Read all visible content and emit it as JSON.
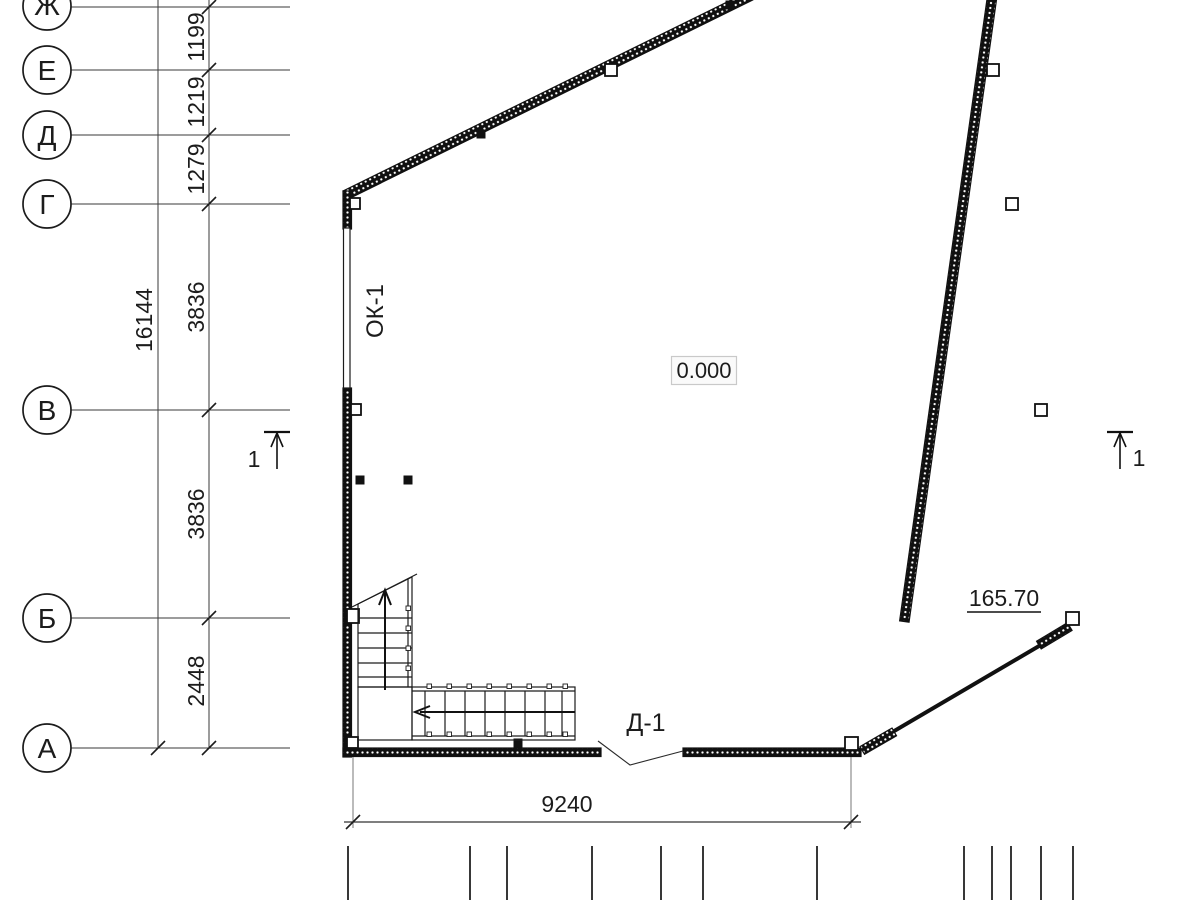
{
  "axes": [
    {
      "label": "Ж"
    },
    {
      "label": "Е"
    },
    {
      "label": "Д"
    },
    {
      "label": "Г"
    },
    {
      "label": "В"
    },
    {
      "label": "Б"
    },
    {
      "label": "А"
    }
  ],
  "dims": {
    "chain": [
      "1199",
      "1219",
      "1279",
      "3836",
      "3836",
      "2448"
    ],
    "total_left": "16144",
    "bottom": "9240"
  },
  "marks": {
    "window": "ОК-1",
    "door": "Д-1",
    "level": "0.000",
    "level_right": "165.70",
    "section_left": "1",
    "section_right": "1"
  }
}
